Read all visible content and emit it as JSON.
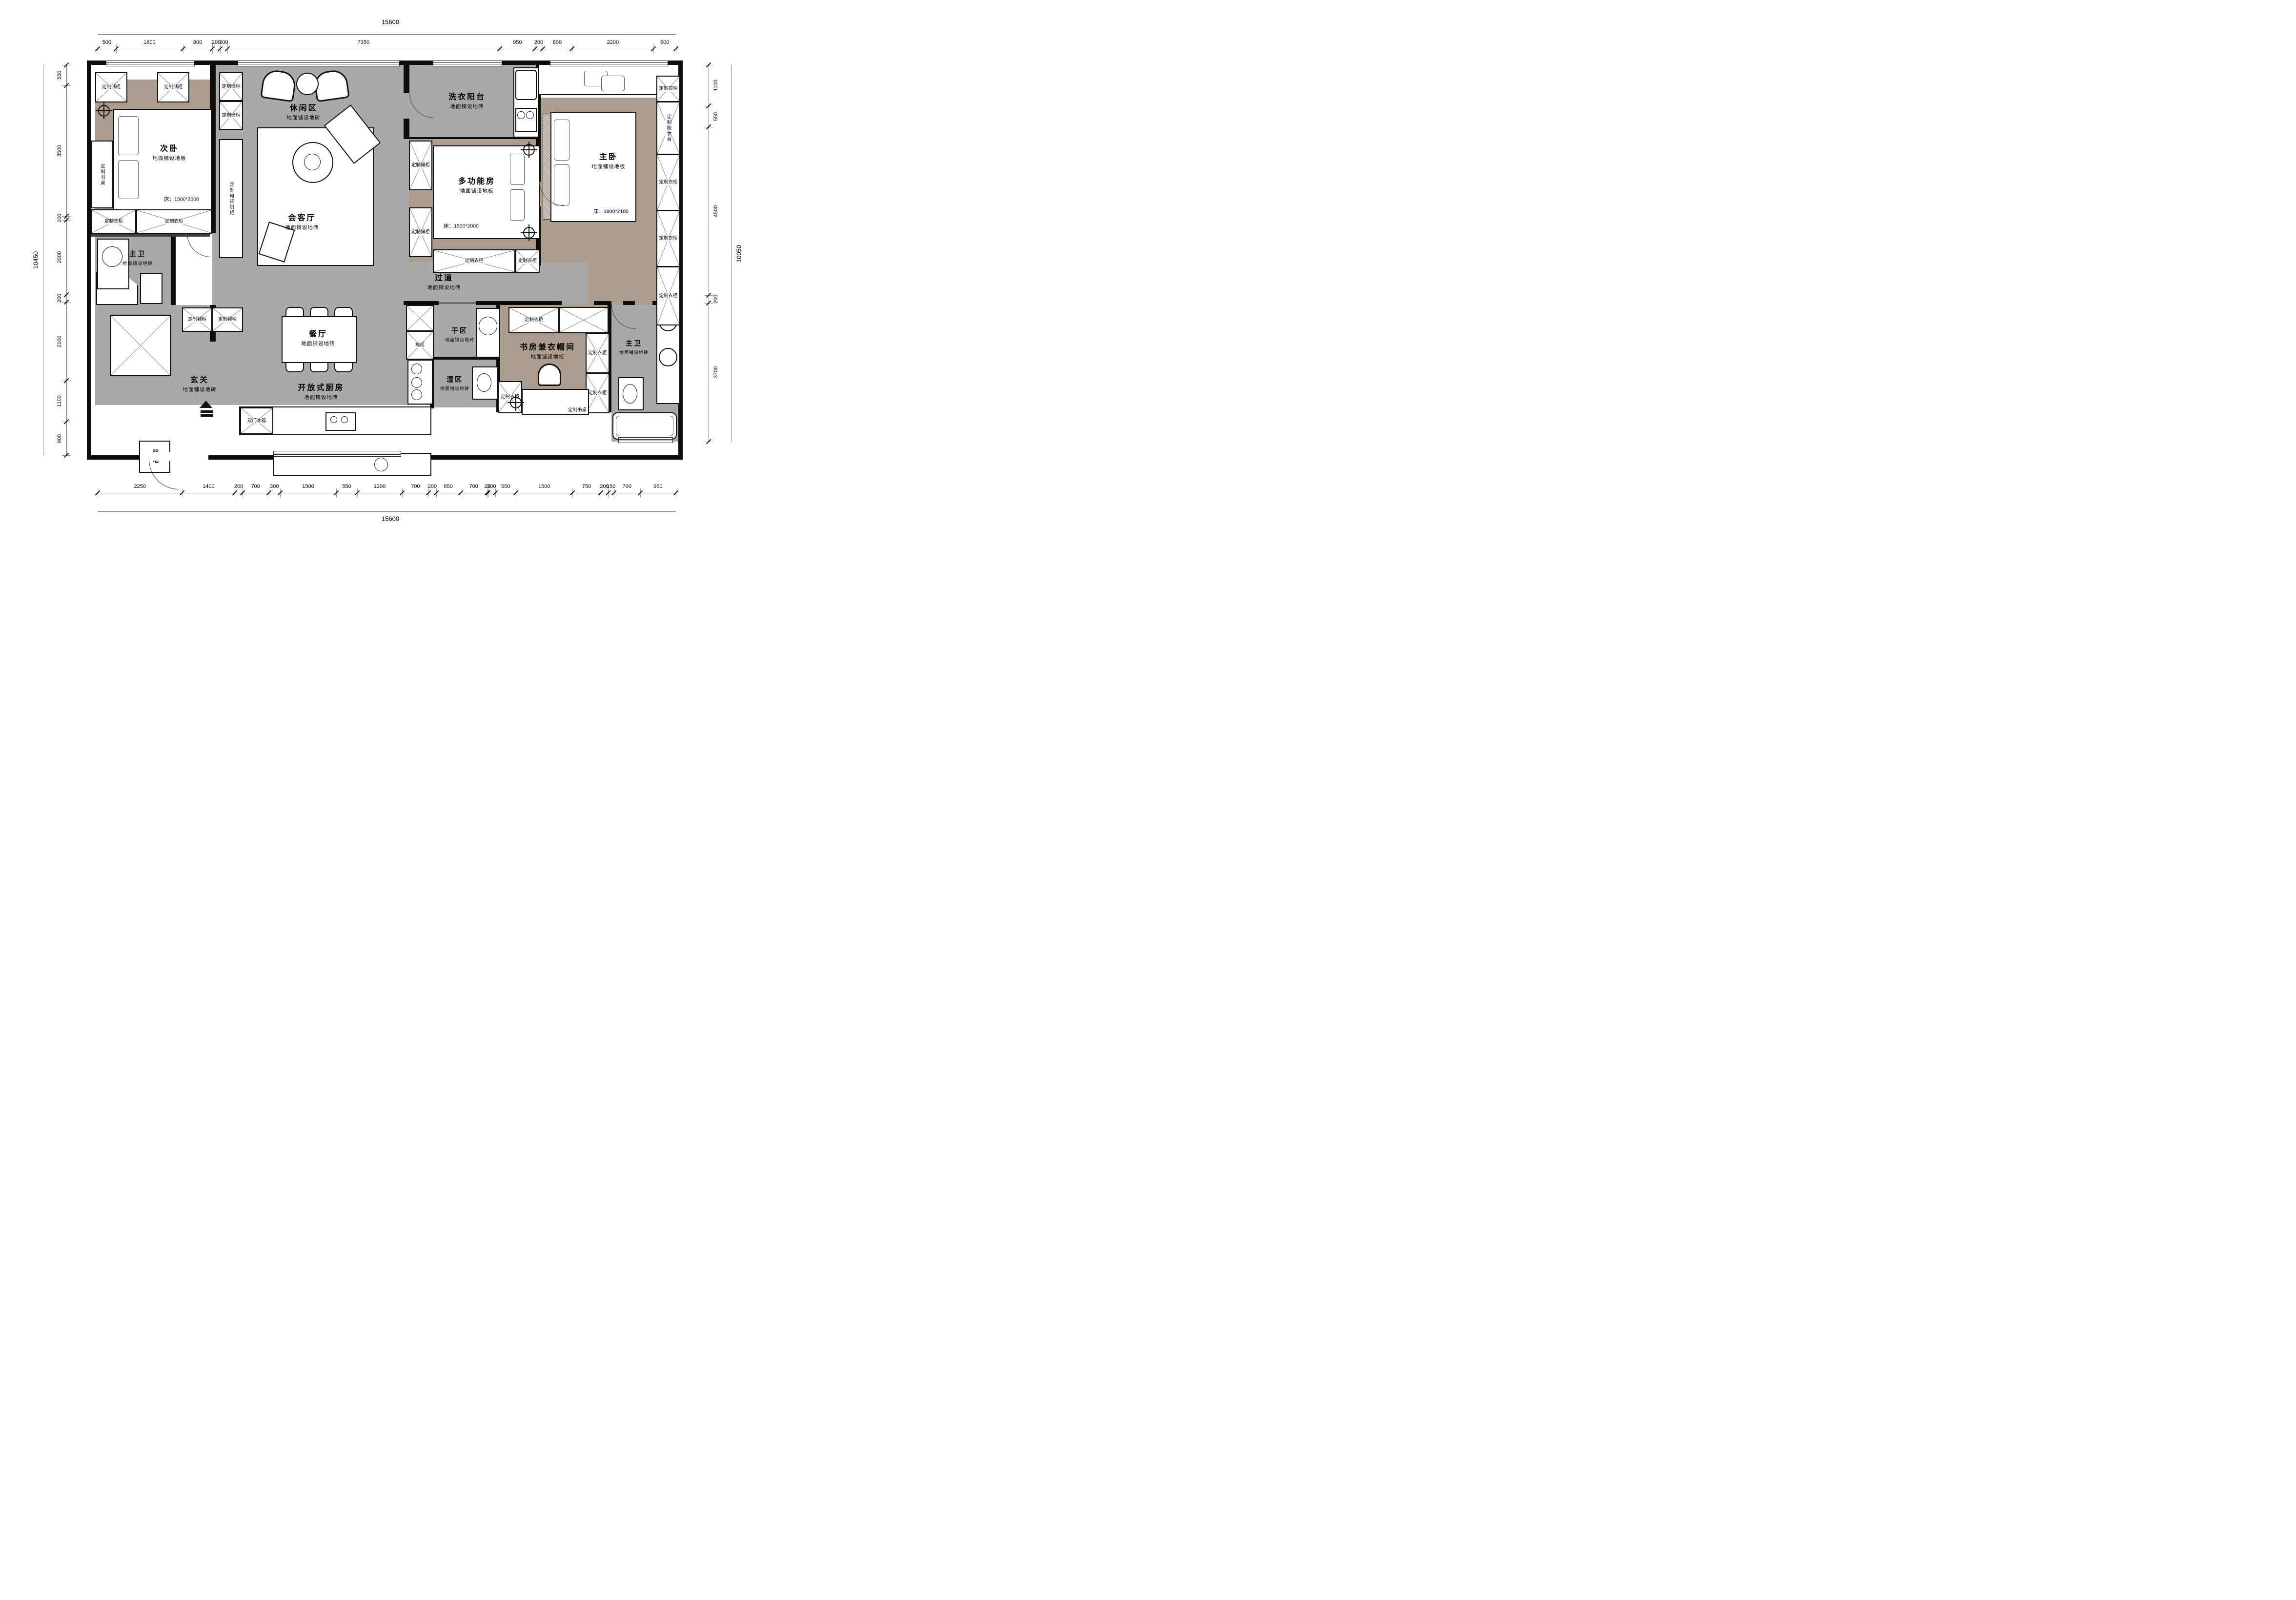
{
  "colors": {
    "tile_floor": "#a9a9a9",
    "wood_floor": "#ab9c8e",
    "wall": "#0d0d0d",
    "wall_accent": "#3a4148",
    "paper": "#ffffff"
  },
  "dimensions": {
    "top_total": "15600",
    "bottom_total": "15600",
    "left_total": "10450",
    "right_total": "10050",
    "top": [
      "500",
      "1800",
      "800",
      "200",
      "200",
      "7350",
      "950",
      "200",
      "800",
      "2200",
      "600"
    ],
    "bottom": [
      "2250",
      "1400",
      "200",
      "700",
      "300",
      "1500",
      "550",
      "1200",
      "700",
      "200",
      "650",
      "700",
      "25",
      "200",
      "550",
      "1500",
      "750",
      "200",
      "150",
      "700",
      "950"
    ],
    "left": [
      "550",
      "3500",
      "100",
      "2000",
      "200",
      "2100",
      "1100",
      "900"
    ],
    "right": [
      "1100",
      "550",
      "4500",
      "200",
      "3700"
    ]
  },
  "rooms": {
    "ciwo": {
      "name": "次卧",
      "floor": "地面铺设地板",
      "bed": "床：1500*2000"
    },
    "xiuxian": {
      "name": "休闲区",
      "floor": "地面铺设地砖"
    },
    "huiketing": {
      "name": "会客厅",
      "floor": "地面铺设地砖"
    },
    "xiyi": {
      "name": "洗衣阳台",
      "floor": "地面铺设地砖"
    },
    "duogongneng": {
      "name": "多功能房",
      "floor": "地面铺设地板",
      "bed": "床：1500*2000"
    },
    "zhuwo": {
      "name": "主卧",
      "floor": "地面铺设地板",
      "bed": "床：1800*2100"
    },
    "zhuwei_l": {
      "name": "主卫",
      "floor": "地面铺设地砖"
    },
    "guodao": {
      "name": "过道",
      "floor": "地面铺设地砖"
    },
    "ganqu": {
      "name": "干区",
      "floor": "地面铺设地砖"
    },
    "shiqu": {
      "name": "湿区",
      "floor": "地面铺设地砖"
    },
    "canting": {
      "name": "餐厅",
      "floor": "地面铺设地砖"
    },
    "xuanguan": {
      "name": "玄关",
      "floor": "地面铺设地砖"
    },
    "chufang": {
      "name": "开放式厨房",
      "floor": "地面铺设地砖"
    },
    "shufang": {
      "name": "书房兼衣帽间",
      "floor": "地面铺设地板"
    },
    "zhuwei_r": {
      "name": "主卫",
      "floor": "地面铺设地砖"
    }
  },
  "cabinets": {
    "c1": "定制储柜",
    "c2": "定制储柜",
    "c3": "定制书桌",
    "c4": "定制衣柜",
    "c5": "定制衣柜",
    "c6": "定制储柜",
    "c7": "定制储柜",
    "c8": "定制电视机柜",
    "c9": "定制储柜",
    "c10": "定制储柜",
    "c11": "定制衣柜",
    "c12": "定制衣柜",
    "c13": "定制衣柜",
    "c14": "定制梳妆台",
    "c15": "定制衣柜",
    "c16": "定制衣柜",
    "c17": "定制衣柜",
    "c18": "定制鞋柜",
    "c19": "定制鞋柜",
    "c20": "高柜",
    "c21": "双门冰箱",
    "c22": "定制衣柜",
    "c23": "定制衣柜",
    "c24": "定制衣柜",
    "c25": "定制衣柜",
    "c26": "定制书桌",
    "c27": "弱电"
  }
}
